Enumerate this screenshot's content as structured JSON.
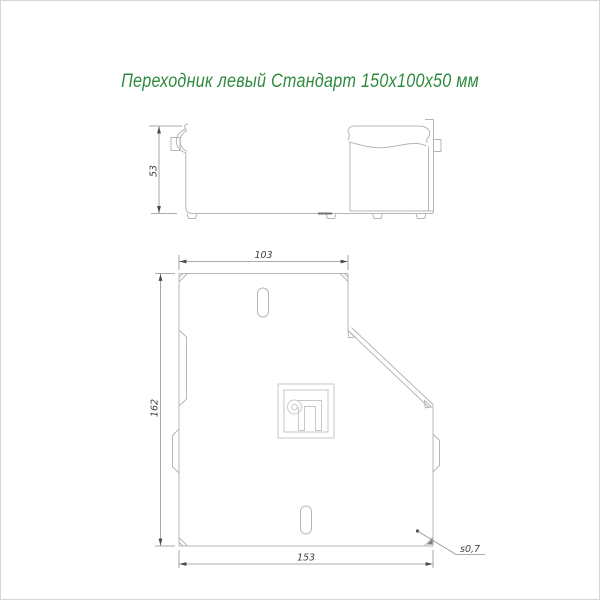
{
  "title": {
    "text": "Переходник левый Стандарт 150х100х50 мм"
  },
  "colors": {
    "title": "#2e8b3e",
    "part_line": "#b4b7b9",
    "dim_line": "#8f9193",
    "dim_text": "#3d3f41",
    "arrow": "#47494b",
    "accent_dark": "#6f7275",
    "background": "#ffffff",
    "border": "#d6d6d6"
  },
  "side_view": {
    "height_dim": "53"
  },
  "plan_view": {
    "top_width_dim": "103",
    "left_height_dim": "162",
    "bottom_width_dim": "153",
    "thickness_note": "s0,7"
  },
  "icons": {
    "logo": "manufacturer-monogram"
  }
}
